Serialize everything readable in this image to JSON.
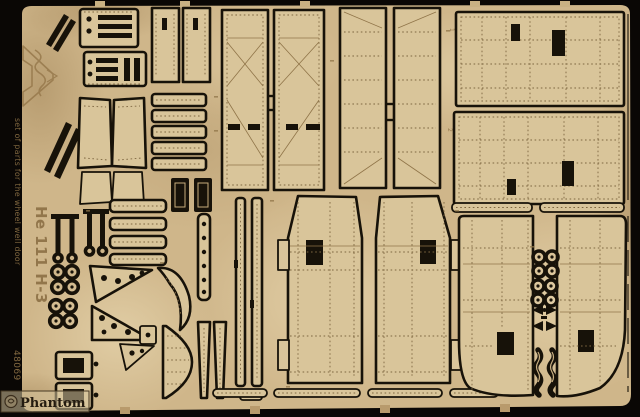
{
  "etched_text": {
    "side_caption": "set of parts for the wheel well door",
    "aircraft_title": "He 111 H-3",
    "product_code": "48069",
    "panel_labels": {
      "panel_1": "1",
      "panel_2": "2"
    }
  },
  "watermark": {
    "text": "Phantom"
  },
  "colors": {
    "background_black": "#0a0705",
    "fret_tan": "#cfb68a",
    "cut_black": "#171209",
    "etch_brown": "#8f7448",
    "etched_text_brown": "#8d7146"
  }
}
